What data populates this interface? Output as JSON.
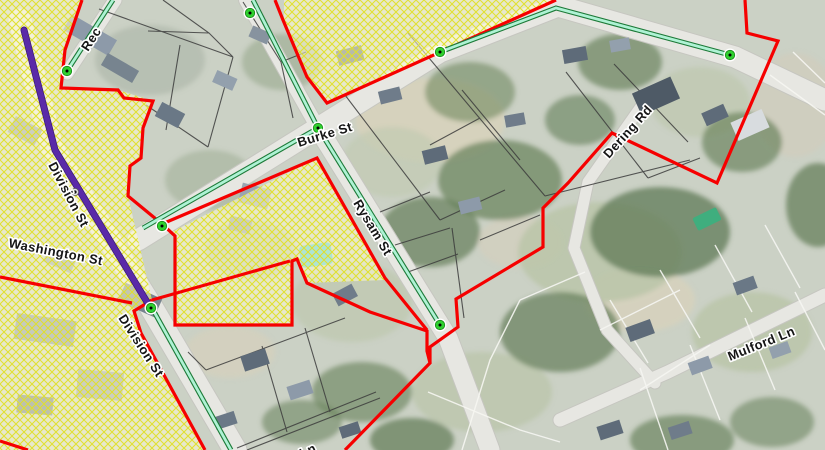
{
  "title": "Village GIS zoning map with aerial imagery",
  "colors": {
    "boundary_red": "#f60000",
    "route_purple": "#5a2aa8",
    "centerline_core": "#aef2d4",
    "centerline_casing": "#1d7a38",
    "node_green": "#2fd02f",
    "hatch_yellow": "#e0e028",
    "hatch_fill": "rgba(255,252,210,0.55)",
    "road_fill": "#e7e7e2",
    "road_edge": "#c6c6c0",
    "parcel_dark": "#3c3c3c",
    "parcel_white": "#f6f6f2",
    "label_color": "#151515",
    "label_halo": "#ffffff"
  },
  "street_labels": [
    {
      "id": "rec-partial",
      "text": "Rec",
      "x": 88,
      "y": 52,
      "rotation": -57
    },
    {
      "id": "division-st-upper",
      "text": "Division St",
      "x": 48,
      "y": 165,
      "rotation": 62
    },
    {
      "id": "washington-st",
      "text": "Washington St",
      "x": 8,
      "y": 247,
      "rotation": 11
    },
    {
      "id": "division-st-lower",
      "text": "Division St",
      "x": 118,
      "y": 318,
      "rotation": 57
    },
    {
      "id": "burke-st",
      "text": "Burke St",
      "x": 299,
      "y": 147,
      "rotation": -17
    },
    {
      "id": "rysam-st",
      "text": "Rysam St",
      "x": 353,
      "y": 203,
      "rotation": 59
    },
    {
      "id": "dering-rd",
      "text": "Dering Rd",
      "x": 609,
      "y": 159,
      "rotation": -48
    },
    {
      "id": "mulford-ln",
      "text": "Mulford Ln",
      "x": 730,
      "y": 361,
      "rotation": -22
    },
    {
      "id": "ln-partial",
      "text": "Ln",
      "x": 302,
      "y": 458,
      "rotation": -24
    }
  ],
  "map": {
    "roads": [
      {
        "name": "division-st",
        "width": 23,
        "points": [
          [
            20,
            20
          ],
          [
            52,
            148
          ],
          [
            150,
            305
          ],
          [
            235,
            450
          ]
        ]
      },
      {
        "name": "rector-st",
        "width": 13,
        "points": [
          [
            67,
            73
          ],
          [
            115,
            0
          ]
        ]
      },
      {
        "name": "burke-st",
        "width": 21,
        "points": [
          [
            138,
            240
          ],
          [
            318,
            128
          ],
          [
            440,
            52
          ],
          [
            558,
            6
          ],
          [
            735,
            57
          ],
          [
            825,
            100
          ]
        ]
      },
      {
        "name": "north-st",
        "width": 14,
        "points": [
          [
            246,
            0
          ],
          [
            318,
            128
          ]
        ]
      },
      {
        "name": "rysam-st",
        "width": 19,
        "points": [
          [
            318,
            128
          ],
          [
            448,
            338
          ],
          [
            490,
            450
          ]
        ]
      },
      {
        "name": "mulford-ln",
        "width": 13,
        "points": [
          [
            825,
            295
          ],
          [
            668,
            372
          ],
          [
            560,
            420
          ]
        ]
      },
      {
        "name": "dering-rd",
        "width": 11,
        "points": [
          [
            640,
            108
          ],
          [
            588,
            182
          ],
          [
            574,
            248
          ],
          [
            607,
            330
          ],
          [
            655,
            383
          ]
        ]
      }
    ],
    "hatch_zones": [
      {
        "name": "west-business-district",
        "points": [
          [
            0,
            0
          ],
          [
            82,
            0
          ],
          [
            65,
            50
          ],
          [
            61,
            88
          ],
          [
            118,
            90
          ],
          [
            153,
            101
          ],
          [
            143,
            128
          ],
          [
            141,
            158
          ],
          [
            130,
            166
          ],
          [
            128,
            196
          ],
          [
            152,
            300
          ],
          [
            134,
            311
          ],
          [
            141,
            333
          ],
          [
            205,
            450
          ],
          [
            0,
            450
          ]
        ]
      },
      {
        "name": "north-parcel",
        "points": [
          [
            284,
            0
          ],
          [
            553,
            0
          ],
          [
            327,
            102
          ],
          [
            308,
            78
          ],
          [
            284,
            21
          ]
        ]
      },
      {
        "name": "central-parcel",
        "points": [
          [
            172,
            232
          ],
          [
            317,
            158
          ],
          [
            385,
            280
          ],
          [
            307,
            283
          ],
          [
            297,
            259
          ],
          [
            292,
            261
          ],
          [
            292,
            325
          ],
          [
            175,
            325
          ],
          [
            175,
            236
          ]
        ]
      }
    ],
    "boundaries": [
      {
        "name": "west-boundary",
        "points": [
          [
            82,
            0
          ],
          [
            65,
            50
          ],
          [
            61,
            88
          ],
          [
            118,
            90
          ],
          [
            124,
            98
          ],
          [
            153,
            101
          ],
          [
            143,
            128
          ],
          [
            141,
            158
          ],
          [
            130,
            166
          ],
          [
            128,
            196
          ],
          [
            162,
            224
          ],
          [
            175,
            236
          ],
          [
            175,
            325
          ],
          [
            292,
            325
          ],
          [
            292,
            261
          ],
          [
            297,
            259
          ],
          [
            307,
            283
          ],
          [
            370,
            312
          ],
          [
            427,
            331
          ],
          [
            427,
            351
          ],
          [
            430,
            363
          ],
          [
            345,
            450
          ]
        ]
      },
      {
        "name": "burke-rysam-boundary",
        "points": [
          [
            162,
            224
          ],
          [
            317,
            158
          ],
          [
            385,
            278
          ],
          [
            427,
            330
          ]
        ]
      },
      {
        "name": "north-parcel-boundary",
        "points": [
          [
            275,
            0
          ],
          [
            283,
            20
          ],
          [
            307,
            77
          ],
          [
            327,
            103
          ],
          [
            556,
            0
          ]
        ]
      },
      {
        "name": "dering-block-boundary",
        "points": [
          [
            745,
            0
          ],
          [
            747,
            33
          ],
          [
            778,
            41
          ],
          [
            717,
            183
          ],
          [
            612,
            133
          ],
          [
            568,
            183
          ],
          [
            543,
            208
          ],
          [
            543,
            247
          ],
          [
            456,
            299
          ],
          [
            458,
            327
          ],
          [
            430,
            347
          ],
          [
            430,
            363
          ]
        ]
      },
      {
        "name": "division-se-boundary",
        "points": [
          [
            152,
            300
          ],
          [
            134,
            311
          ],
          [
            141,
            333
          ],
          [
            205,
            450
          ]
        ]
      },
      {
        "name": "division-cross-boundary",
        "points": [
          [
            152,
            300
          ],
          [
            290,
            261
          ]
        ]
      },
      {
        "name": "sw-edge-boundary",
        "points": [
          [
            0,
            277
          ],
          [
            132,
            303
          ]
        ]
      },
      {
        "name": "bottom-left-boundary",
        "points": [
          [
            0,
            441
          ],
          [
            28,
            450
          ]
        ]
      }
    ],
    "purple_route": {
      "name": "division-st-route",
      "points": [
        [
          24,
          30
        ],
        [
          55,
          150
        ],
        [
          147,
          302
        ]
      ],
      "width": 5.5
    },
    "centerlines": [
      {
        "name": "rector-centerline",
        "points": [
          [
            67,
            71
          ],
          [
            113,
            0
          ]
        ]
      },
      {
        "name": "north-centerline",
        "points": [
          [
            253,
            0
          ],
          [
            318,
            128
          ]
        ]
      },
      {
        "name": "burke-centerline",
        "points": [
          [
            143,
            228
          ],
          [
            318,
            128
          ]
        ]
      },
      {
        "name": "rysam-centerline",
        "points": [
          [
            318,
            128
          ],
          [
            440,
            325
          ]
        ]
      },
      {
        "name": "upper-right-centerline",
        "points": [
          [
            440,
            52
          ],
          [
            556,
            8
          ],
          [
            730,
            55
          ]
        ]
      },
      {
        "name": "division-centerline",
        "points": [
          [
            152,
            308
          ],
          [
            231,
            450
          ]
        ]
      }
    ],
    "nodes": [
      {
        "x": 67,
        "y": 71
      },
      {
        "x": 250,
        "y": 13
      },
      {
        "x": 318,
        "y": 128
      },
      {
        "x": 162,
        "y": 226
      },
      {
        "x": 440,
        "y": 325
      },
      {
        "x": 440,
        "y": 52
      },
      {
        "x": 730,
        "y": 55
      },
      {
        "x": 151,
        "y": 308
      }
    ],
    "point_markers": [
      {
        "x": 75,
        "y": 192
      }
    ]
  }
}
